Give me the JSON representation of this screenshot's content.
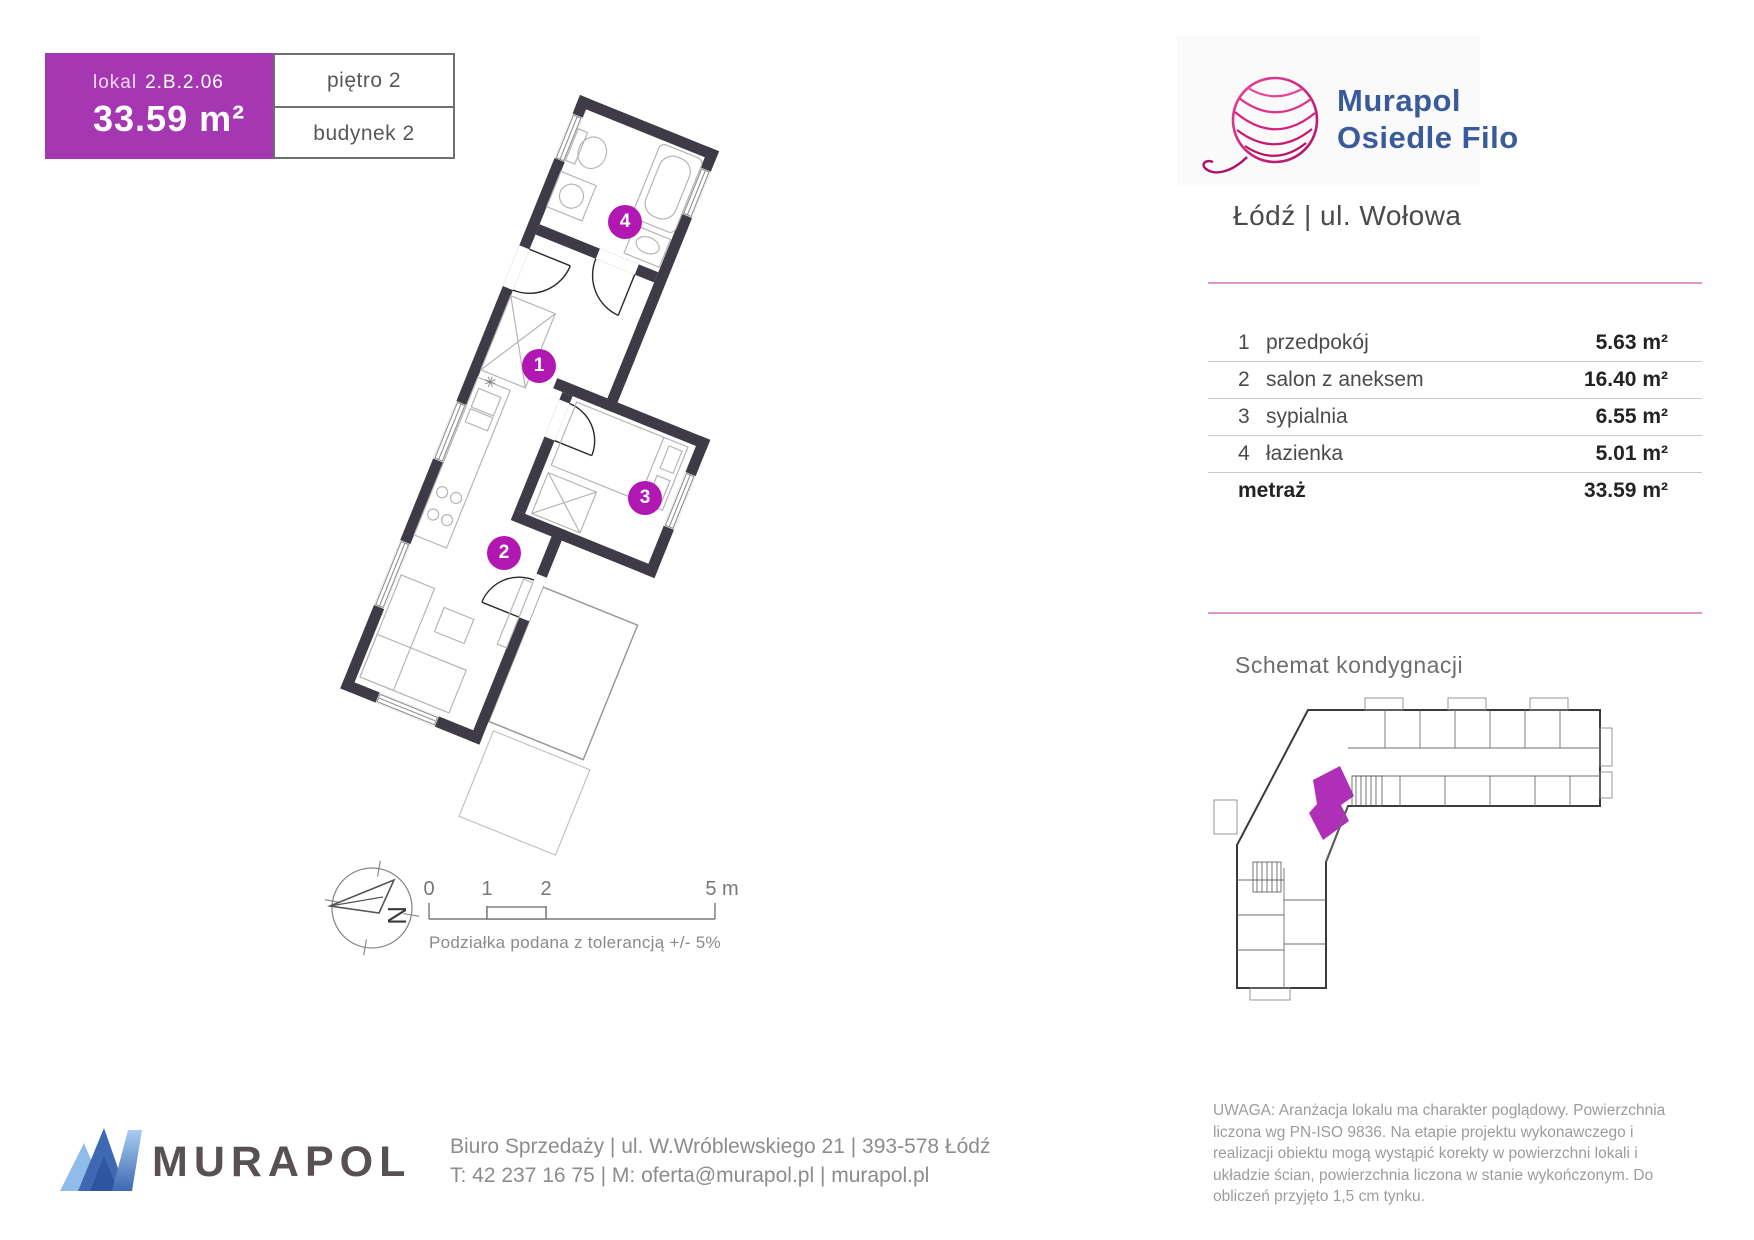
{
  "header": {
    "lokal_label": "lokal",
    "lokal_code": "2.B.2.06",
    "area": "33.59 m²",
    "floor": "piętro 2",
    "building": "budynek 2"
  },
  "brand": {
    "name_line1": "Murapol",
    "name_line2": "Osiedle Filo",
    "location": "Łódź | ul. Wołowa"
  },
  "table": {
    "rows": [
      {
        "no": "1",
        "name": "przedpokój",
        "area": "5.63 m²"
      },
      {
        "no": "2",
        "name": "salon z aneksem",
        "area": "16.40 m²"
      },
      {
        "no": "3",
        "name": "sypialnia",
        "area": "6.55 m²"
      },
      {
        "no": "4",
        "name": "łazienka",
        "area": "5.01 m²"
      }
    ],
    "total_label": "metraż",
    "total_area": "33.59 m²"
  },
  "plan": {
    "badges": [
      {
        "no": "1"
      },
      {
        "no": "2"
      },
      {
        "no": "3"
      },
      {
        "no": "4"
      }
    ],
    "compass_letter": "N"
  },
  "scalebar": {
    "tick0": "0",
    "tick1": "1",
    "tick2": "2",
    "tick5": "5 m",
    "note": "Podziałka podana z tolerancją +/- 5%"
  },
  "schematic": {
    "title": "Schemat kondygnacji"
  },
  "footer": {
    "brand": "MURAPOL",
    "address": "Biuro Sprzedaży | ul. W.Wróblewskiego 21 | 393-578 Łódź",
    "contact": "T: 42 237 16 75 | M: oferta@murapol.pl | murapol.pl"
  },
  "disclaimer": "UWAGA: Aranżacja lokalu ma charakter poglądowy. Powierzchnia liczona wg PN-ISO 9836. Na etapie projektu wykonawczego i realizacji obiektu mogą wystąpić korekty w powierzchni lokali i układzie ścian, powierzchnia liczona w stanie wykończonym. Do obliczeń przyjęto 1,5 cm tynku.",
  "colors": {
    "accent_purple": "#A637B2",
    "badge_purple": "#B118B1",
    "pink_line": "#D79BCB",
    "brand_blue": "#3A5B9B",
    "logo_pink": "#D6217E",
    "wall_dark": "#3E3B47"
  }
}
